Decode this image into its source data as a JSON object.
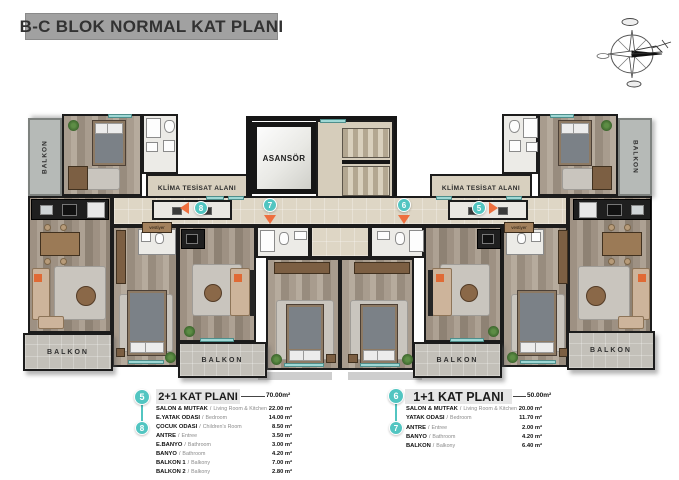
{
  "title": "B-C BLOK NORMAL KAT PLANI",
  "compass_icon": "compass-rose",
  "plan": {
    "elevator_label": "ASANSÖR",
    "klima_label": "KLİMA TESİSAT ALANI",
    "balkon_label": "BALKON",
    "vestiyer_label": "vestiyer",
    "markers": {
      "m5": "5",
      "m6": "6",
      "m7": "7",
      "m8": "8"
    }
  },
  "separator": "/",
  "legends": [
    {
      "marker_top": "5",
      "marker_row": "8",
      "title": "2+1 KAT PLANI",
      "total": "70.00m²",
      "rows": [
        {
          "name": "SALON & MUTFAK",
          "sub": "Living Room & Kitchen",
          "value": "22.00 m²"
        },
        {
          "name": "E.YATAK ODASI",
          "sub": "Bedroom",
          "value": "14.00 m²"
        },
        {
          "name": "ÇOCUK ODASI",
          "sub": "Children's Room",
          "value": "8.50 m²"
        },
        {
          "name": "ANTRE",
          "sub": "Entree",
          "value": "3.50 m²"
        },
        {
          "name": "E.BANYO",
          "sub": "Bathroom",
          "value": "3.00 m²"
        },
        {
          "name": "BANYO",
          "sub": "Bathroom",
          "value": "4.20 m²"
        },
        {
          "name": "BALKON 1",
          "sub": "Balkony",
          "value": "7.00 m²"
        },
        {
          "name": "BALKON 2",
          "sub": "Balkony",
          "value": "2.80 m²"
        }
      ]
    },
    {
      "marker_top": "6",
      "marker_row": "7",
      "title": "1+1 KAT PLANI",
      "total": "50.00m²",
      "rows": [
        {
          "name": "SALON & MUTFAK",
          "sub": "Living Room & Kitchen",
          "value": "20.00 m²"
        },
        {
          "name": "YATAK ODASI",
          "sub": "Bedroom",
          "value": "11.70 m²"
        },
        {
          "name": "ANTRE",
          "sub": "Entree",
          "value": "2.00 m²"
        },
        {
          "name": "BANYO",
          "sub": "Bathroom",
          "value": "4.20 m²"
        },
        {
          "name": "BALKON",
          "sub": "Balkony",
          "value": "6.40 m²"
        }
      ]
    }
  ],
  "colors": {
    "accent_teal": "#52c5c1",
    "accent_orange": "#ee6f3f",
    "wall": "#1c1c1c",
    "title_bar_bg": "#a1a1a1",
    "legend_header_bg": "#e6e6e6"
  }
}
